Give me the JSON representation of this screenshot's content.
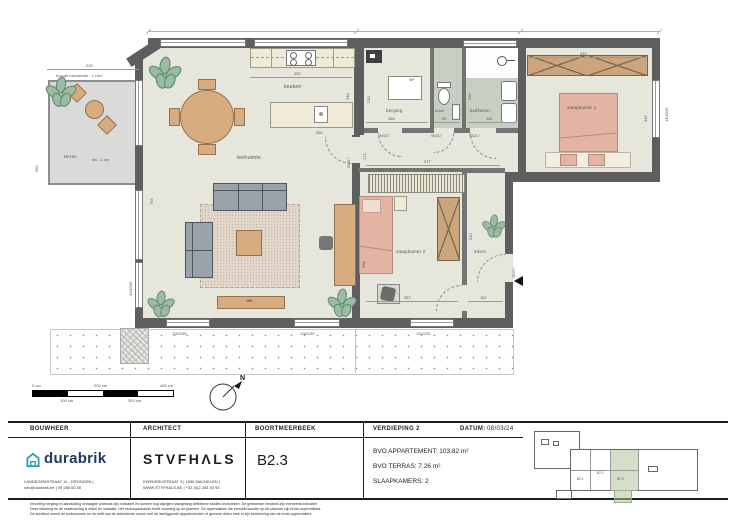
{
  "plan": {
    "labels": {
      "terras": "terras",
      "niveau": "niv. -2 cm",
      "balustrade": "hoogte balustrade : 1.10m",
      "keuken": "keuken",
      "leefruimte": "leefruimte",
      "berging": "berging",
      "toilet": "toilet",
      "badkamer": "badkamer",
      "slaapkamer1": "slaapkamer 1",
      "slaapkamer2": "slaapkamer 2",
      "inkom": "inkom",
      "wp": "WP",
      "tv_dressoir": "199"
    },
    "dims": {
      "terras_b": "230",
      "terras_d": "560",
      "living_h": "755",
      "keuken_b": "300",
      "keuken_d": "240",
      "eiland": "260",
      "berging_b": "186",
      "berging_d": "230",
      "toilet_b": "90",
      "badkamer_b": "161",
      "badkamer_d": "230",
      "sk1_b": "340",
      "sk1_d": "345",
      "hal": "377",
      "hal_d": "171",
      "sk2_d": "328",
      "sk2_b": "287",
      "sk2_h": "510",
      "inkom_b": "110"
    },
    "openings": {
      "window_std": "100/235",
      "window_sk1": "140/235",
      "door_int": "90/217",
      "door_entry": "98/217"
    },
    "scalebar": {
      "t0": "0 cm",
      "t100": "100 cm",
      "t200": "200 cm",
      "t300": "300 cm",
      "t400": "400 cm"
    },
    "north": "N"
  },
  "titleblock": {
    "bouwheer": {
      "header": "BOUWHEER",
      "brand": "durabrik",
      "addr1": "LANDEGEMSTRAAT 10 - DRONGEN |",
      "addr2": "info@durabrik.be | 09 280 60 60"
    },
    "architect": {
      "header": "ARCHITECT",
      "brand": "STVFHΛLS",
      "addr1": "KWEKERIJSTRAAT 3 | 1830 MACHELEN |",
      "addr2": "WWW.STYFHALS.BE | +32 (0)2 253 40 53"
    },
    "project": {
      "header": "BOORTMEERBEEK",
      "unit": "B2.3"
    },
    "info": {
      "floor": "VERDIEPING 2",
      "date_label": "DATUM:",
      "date": "08/03/24",
      "bvo_app": "BVO APPARTEMENT: 103.82 m²",
      "bvo_terras": "BVO TERRAS: 7.26 m²",
      "bedrooms": "SLAAPKAMERS:   2"
    },
    "keyplan": {
      "b21": "B2.1",
      "b22": "B2.2",
      "b23": "B2.3"
    }
  },
  "disclaimer": {
    "line1": "Inrichting berging en aanduiding verlaagde plafonds zijn indicatief en kunnen nog wijzigen naargelang definitieve studies technieken. De getekende meubels zijn eveneens indicatief.",
    "line2": "Deze tekening en de maatvoering is enkel ter indicatie. Het verkoopsdossier heeft voorrang op de plannen. De oppervlaktes die vermeld worden op de plannen zijn bruto-oppervlaktes.",
    "line3": "De architect neemt de buitenmuren en de helft van de scheidende muren met de aanliggende appartementen of gemene delen mee in zijn berekening van de bruto-oppervlaktes."
  }
}
